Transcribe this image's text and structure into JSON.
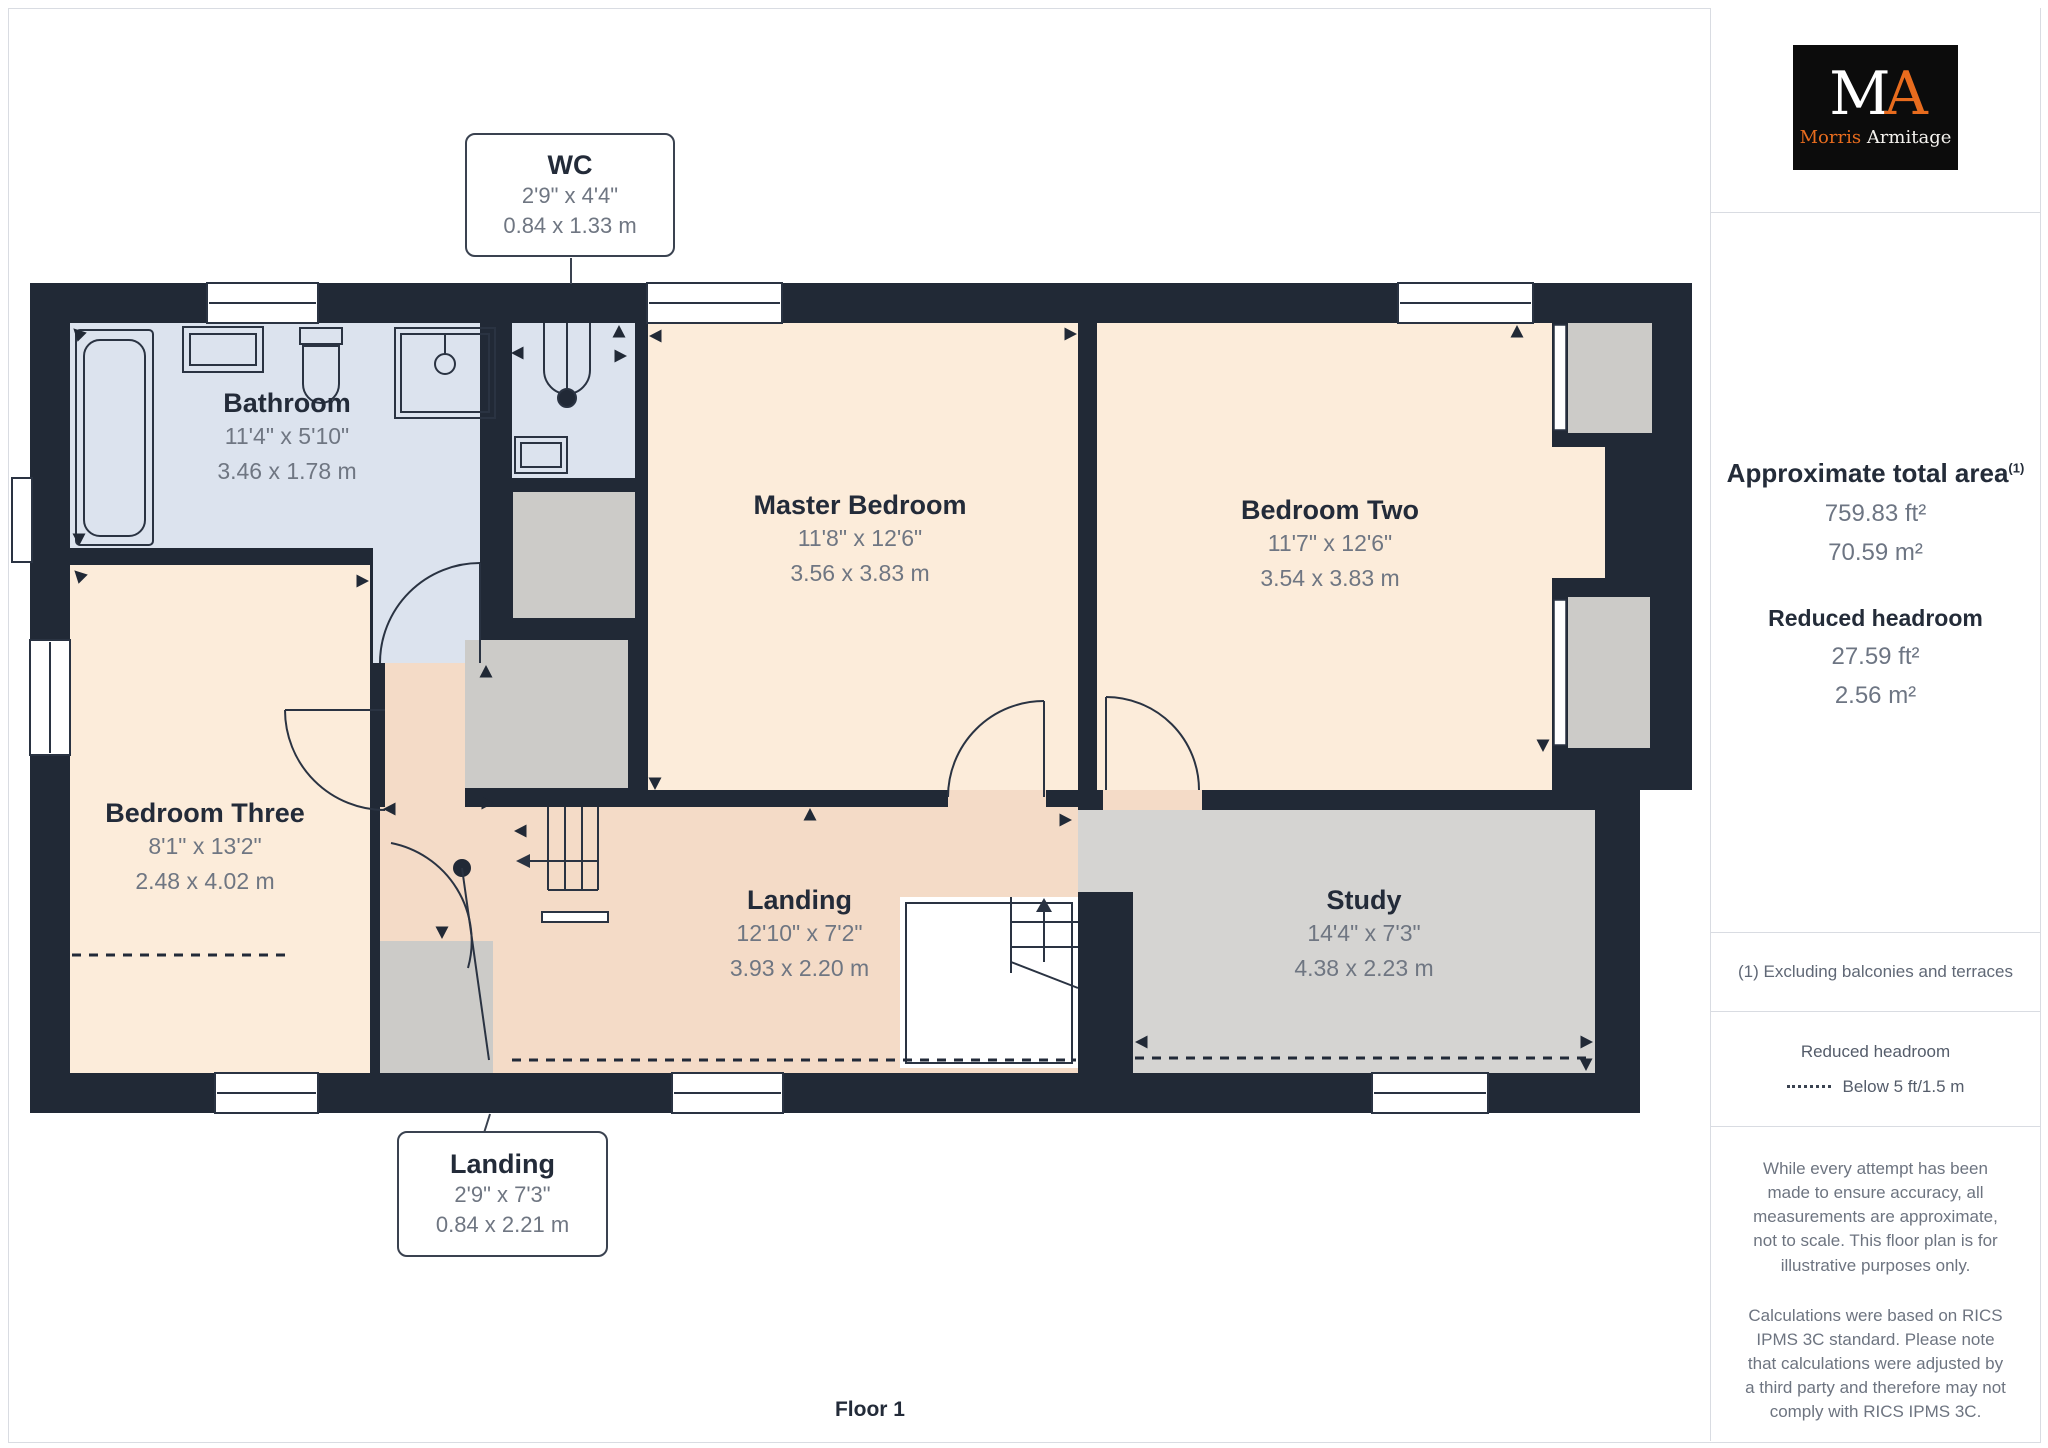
{
  "floor_label": "Floor 1",
  "rooms": [
    {
      "name": "Bathroom",
      "imperial": "11'4\" x 5'10\"",
      "metric": "3.46 x 1.78 m"
    },
    {
      "name": "Master Bedroom",
      "imperial": "11'8\" x 12'6\"",
      "metric": "3.56 x 3.83 m"
    },
    {
      "name": "Bedroom Two",
      "imperial": "11'7\" x 12'6\"",
      "metric": "3.54 x 3.83 m"
    },
    {
      "name": "Bedroom Three",
      "imperial": "8'1\" x 13'2\"",
      "metric": "2.48 x 4.02 m"
    },
    {
      "name": "Landing",
      "imperial": "12'10\" x 7'2\"",
      "metric": "3.93 x 2.20 m"
    },
    {
      "name": "Study",
      "imperial": "14'4\" x 7'3\"",
      "metric": "4.38 x 2.23 m"
    }
  ],
  "callouts": [
    {
      "name": "WC",
      "imperial": "2'9\" x 4'4\"",
      "metric": "0.84 x 1.33 m"
    },
    {
      "name": "Landing",
      "imperial": "2'9\" x 7'3\"",
      "metric": "0.84 x 2.21 m"
    }
  ],
  "sidebar": {
    "logo": {
      "monogram_m": "M",
      "monogram_a": "A",
      "name_first": "Morris",
      "name_last": "Armitage"
    },
    "total_area_label": "Approximate total area",
    "total_area_superscript": "(1)",
    "total_area_ft": "759.83 ft²",
    "total_area_m": "70.59 m²",
    "reduced_headroom_label": "Reduced headroom",
    "reduced_headroom_ft": "27.59 ft²",
    "reduced_headroom_m": "2.56 m²",
    "footnote": "(1) Excluding balconies and terraces",
    "legend_title": "Reduced headroom",
    "legend_value": "Below 5 ft/1.5 m",
    "disclaimer1": "While every attempt has been made to ensure accuracy, all measurements are approximate, not to scale. This floor plan is for illustrative purposes only.",
    "disclaimer2": "Calculations were based on RICS IPMS 3C standard. Please note that calculations were adjusted by a third party and therefore may not comply with RICS IPMS 3C.",
    "brand": "GIRAFFE",
    "brand_suffix": "360"
  },
  "colors": {
    "wall": "#212936",
    "bathroom_fill": "#dce3ee",
    "bedroom_fill": "#fcecda",
    "landing_fill": "#f4dbc7",
    "study_fill": "#d5d4d2",
    "closet_fill": "#cccbc8",
    "logo_orange": "#e86c1e",
    "text_dark": "#242c39",
    "text_gray": "#6d7583"
  }
}
